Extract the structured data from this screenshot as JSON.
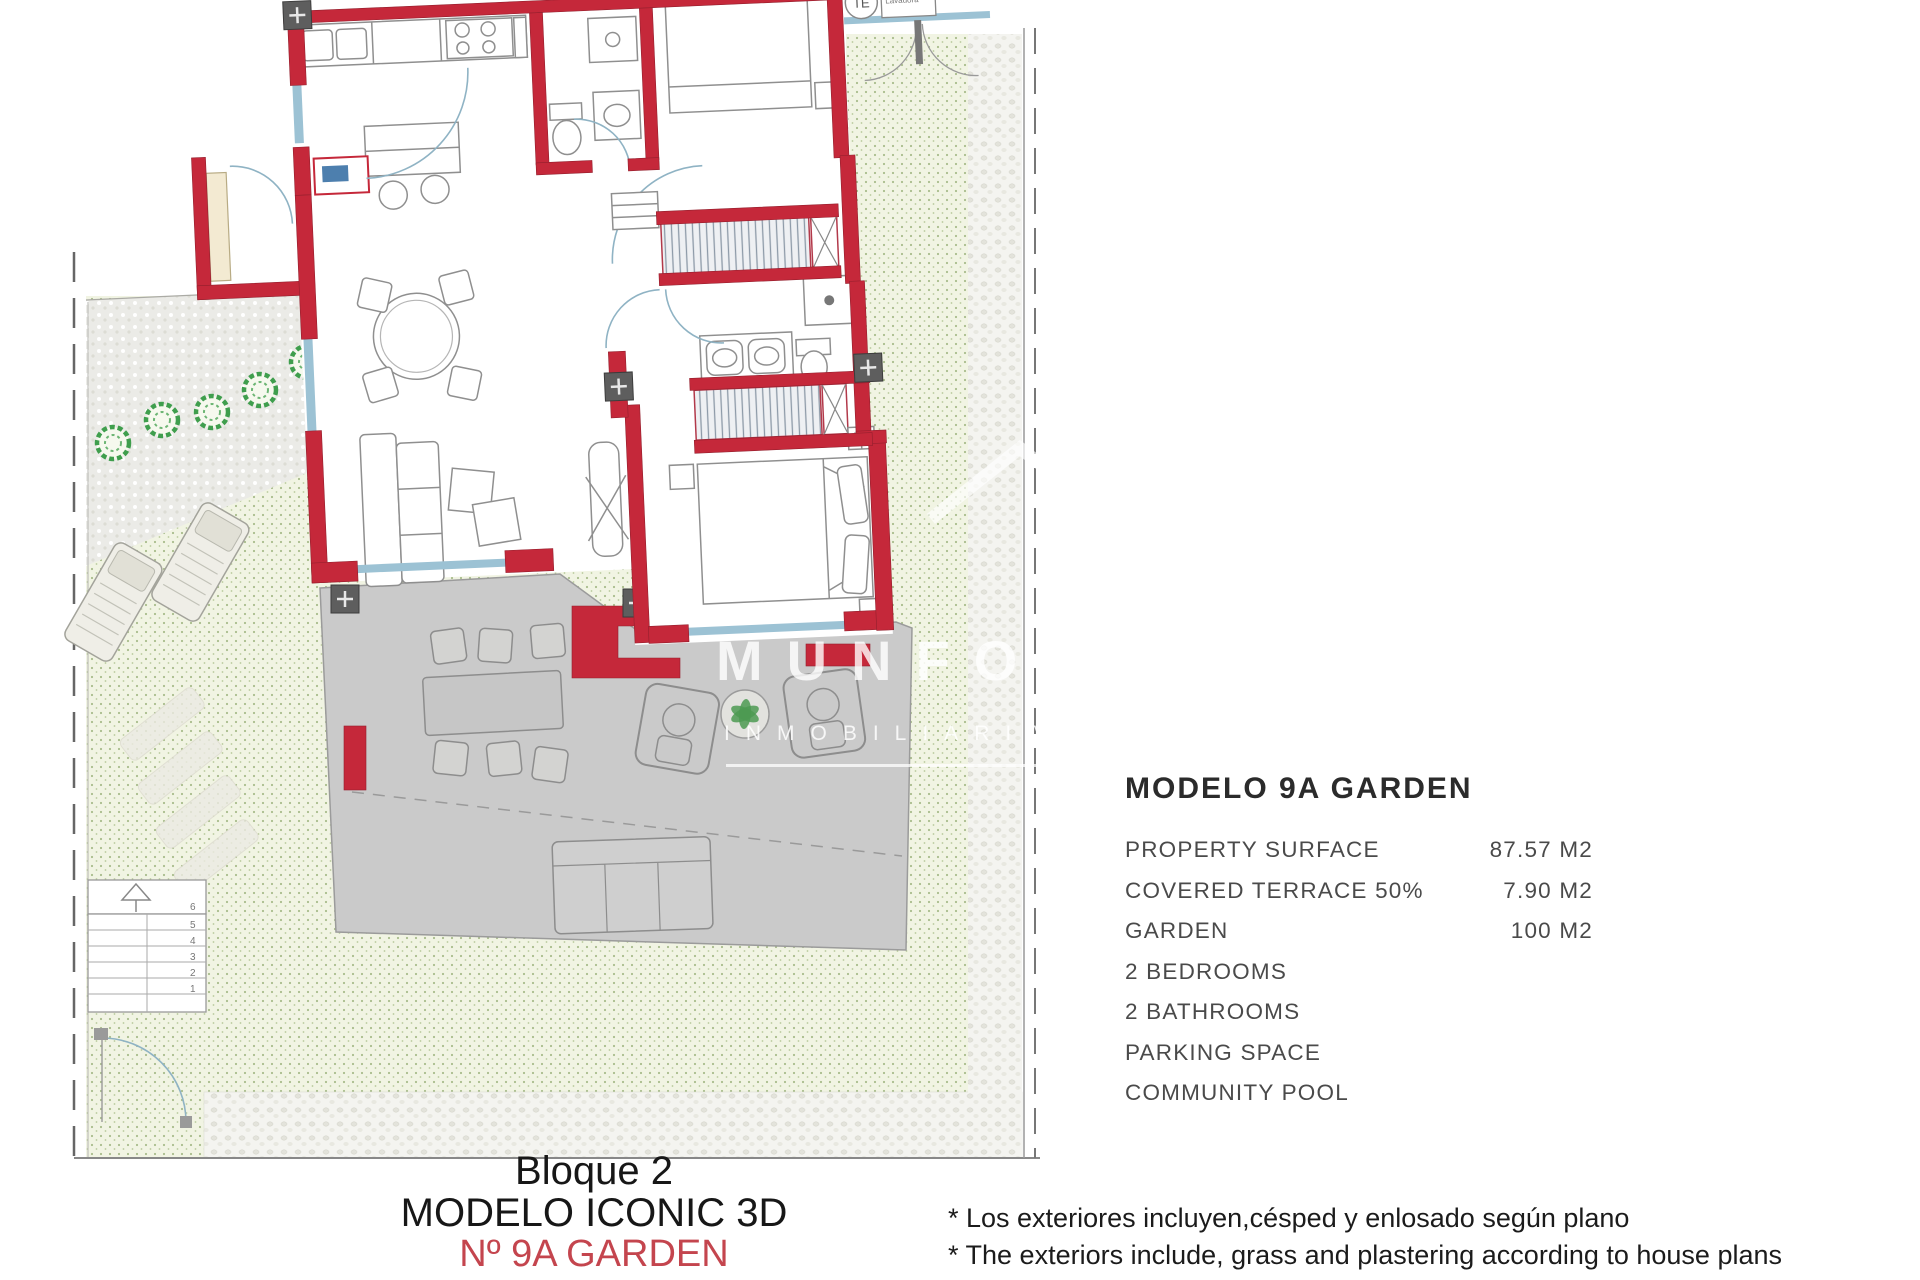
{
  "watermark": {
    "brand": "MUNFORT",
    "tagline": "INMOBILIARIA"
  },
  "plan": {
    "labels": {
      "te": "TE",
      "lavadora": "Lavadora"
    },
    "stairs": {
      "steps": [
        "6",
        "5",
        "4",
        "3",
        "2",
        "1"
      ]
    }
  },
  "details_panel": {
    "title": "MODELO 9A GARDEN",
    "rows": [
      {
        "label": "PROPERTY SURFACE",
        "value": "87.57 M2"
      },
      {
        "label": "COVERED TERRACE 50%",
        "value": "7.90 M2"
      },
      {
        "label": "GARDEN",
        "value": "100 M2"
      },
      {
        "label": "2 BEDROOMS",
        "value": ""
      },
      {
        "label": "2 BATHROOMS",
        "value": ""
      },
      {
        "label": "PARKING SPACE",
        "value": ""
      },
      {
        "label": "COMMUNITY POOL",
        "value": ""
      }
    ]
  },
  "caption": {
    "line1": "Bloque 2",
    "line2": "MODELO ICONIC 3D",
    "line3": "Nº 9A GARDEN"
  },
  "notes": [
    "* Los exteriores incluyen,césped y enlosado según plano",
    "* The exteriors include, grass and plastering according to house plans"
  ],
  "colors": {
    "wall_red": "#c5283a",
    "window_blue": "#9cc2d4",
    "terrace_gray": "#cacaca",
    "lawn_green": "#f1f4e3",
    "tree_green": "#3f9e4d",
    "caption_red": "#c4454e"
  }
}
